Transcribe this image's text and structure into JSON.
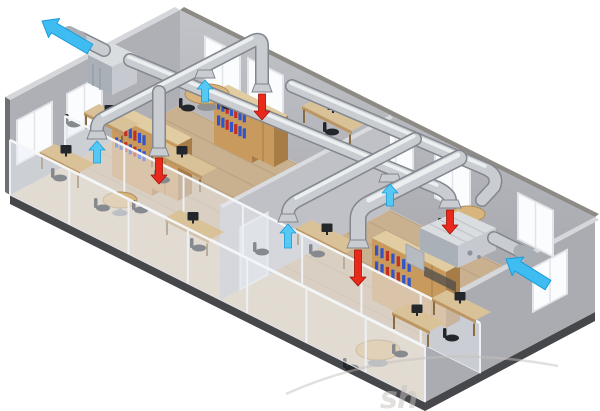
{
  "watermark": {
    "text": "sh"
  },
  "colors": {
    "wall-back-a": "#c2c3c8",
    "wall-back-b": "#a4a5ab",
    "wall-left": "#aeb0b5",
    "wall-right": "#abacb2",
    "wall-top-light": "#d6d7da",
    "wall-top-dark": "#8e8a86",
    "partition": "#c0c1c7",
    "partition-top": "#dadbde",
    "floor": "#c9b190",
    "plank": "#b0997a",
    "floor-office": "#ded2bc",
    "slab-dark": "#46474b",
    "slab-mid": "#6e6f74",
    "duct-edge": "#82878e",
    "duct-core": "#c9cdd2",
    "duct-hi": "#f2f4f6",
    "duct-collar": "#a9aeb5",
    "metal-top": "#dadde0",
    "metal-front": "#aab0b7",
    "metal-side": "#c6cad0",
    "supply-red": "#e8291c",
    "supply-red-edge": "#a31408",
    "extract-blue": "#55c8f4",
    "extract-blue-edge": "#1a9cd8",
    "flow-blue": "#3fbdf2",
    "wood": "#c89a5e",
    "wood-dark": "#a87c46",
    "wood-top": "#e2cda2",
    "desk-top": "#d9c298",
    "desk-edge": "#bd9763",
    "binder-blue": "#2f55cc",
    "binder-red": "#c52f22",
    "dark-item": "#23262b",
    "glass": "rgba(233,238,244,0.5)",
    "glass-frame": "#e3e6ea",
    "window": "#fbfcfe",
    "window-frame": "#e3e4e8",
    "watermark": "#c6c2be"
  },
  "airflow": {
    "supply_air": {
      "color_key": "supply-red",
      "arrows": [
        {
          "x": 262,
          "y1": 94,
          "y2": 120
        },
        {
          "x": 159,
          "y1": 158,
          "y2": 184
        },
        {
          "x": 450,
          "y1": 210,
          "y2": 234
        },
        {
          "x": 358,
          "y1": 250,
          "y2": 286
        }
      ]
    },
    "extract_air": {
      "color_key": "extract-blue",
      "arrows": [
        {
          "x": 205,
          "tip": 80,
          "tail": 102
        },
        {
          "x": 97,
          "tip": 141,
          "tail": 163
        },
        {
          "x": 390,
          "tip": 184,
          "tail": 206
        },
        {
          "x": 288,
          "tip": 224,
          "tail": 248
        }
      ]
    },
    "exhaust_outlet": {
      "tail": [
        90,
        49
      ],
      "tip": [
        42,
        21
      ]
    },
    "fresh_air_intake": {
      "tail": [
        548,
        285
      ],
      "tip": [
        506,
        259
      ]
    }
  },
  "windows": {
    "back": [
      {
        "a": 25
      },
      {
        "a": 68
      },
      {
        "a": 198
      },
      {
        "a": 255
      },
      {
        "a": 338
      }
    ],
    "left": [
      {
        "a": 78
      },
      {
        "a": 128
      }
    ],
    "right": [
      {
        "a": 28
      }
    ]
  },
  "furniture": {
    "cabinets": [
      [
        112,
        114,
        40,
        62,
        1
      ],
      [
        152,
        132,
        26,
        56,
        0
      ],
      [
        214,
        92,
        38,
        52,
        1
      ],
      [
        252,
        112,
        22,
        44,
        0
      ],
      [
        372,
        238,
        46,
        62,
        1
      ],
      [
        418,
        258,
        28,
        56,
        0
      ]
    ],
    "desks": {
      "main": [
        [
          84,
          112,
          40
        ],
        [
          150,
          150,
          52
        ],
        [
          302,
          106,
          50
        ],
        [
          296,
          228,
          50
        ]
      ],
      "office": [
        [
          40,
          152,
          40
        ],
        [
          165,
          218,
          44
        ],
        [
          392,
          312,
          38
        ],
        [
          432,
          298,
          44
        ]
      ]
    },
    "tables": {
      "main": [
        [
          207,
          94,
          22,
          10
        ],
        [
          468,
          214,
          17,
          8
        ]
      ],
      "office": [
        [
          120,
          200,
          17,
          8
        ],
        [
          378,
          350,
          22,
          10
        ]
      ]
    },
    "chairs": {
      "main": [
        [
          74,
          124
        ],
        [
          188,
          108
        ],
        [
          229,
          106
        ],
        [
          332,
          132
        ],
        [
          163,
          180
        ],
        [
          318,
          254
        ],
        [
          262,
          252
        ],
        [
          447,
          228
        ]
      ],
      "office": [
        [
          103,
          208
        ],
        [
          141,
          210
        ],
        [
          199,
          248
        ],
        [
          352,
          368
        ],
        [
          401,
          354
        ],
        [
          452,
          338
        ],
        [
          60,
          178
        ]
      ]
    }
  }
}
